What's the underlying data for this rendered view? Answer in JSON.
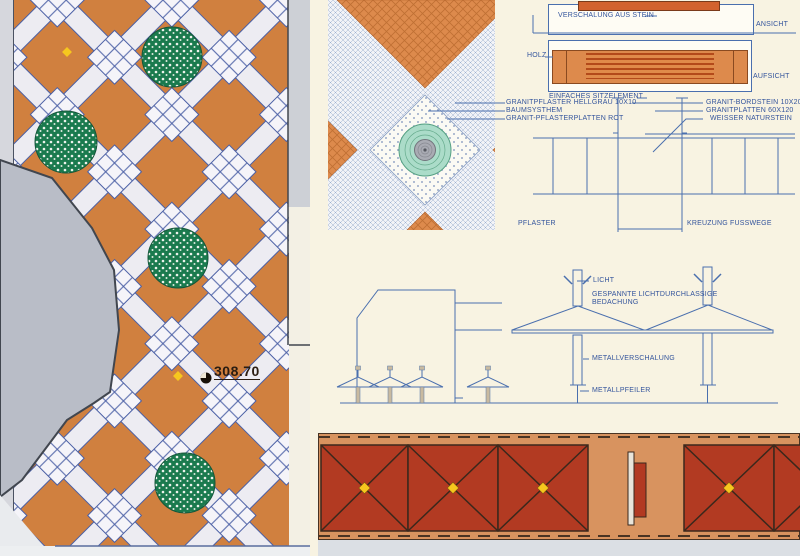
{
  "colors": {
    "paper": "#f8f3e2",
    "plan-orange": "#d0803f",
    "lattice-white": "#edecf2",
    "plaza-gray": "#b9bdc7",
    "walk-gray": "#cdd0d6",
    "tree-green": "#1a7a4e",
    "accent-yellow": "#f6c71e",
    "line-blue": "#4a6fae",
    "label-blue": "#33549c",
    "detail-orange": "#dd8a4c",
    "teal": "#abdcc9",
    "strip-orange": "#d8935f",
    "strip-red": "#b23a22",
    "bench-red": "#d2622e"
  },
  "plan": {
    "spot_elevation": "308.70"
  },
  "bench_detail": {
    "verschalung_label": "VERSCHALUNG AUS STEIN",
    "front_view_label": "ANSICHT",
    "material_label": "HOLZ",
    "top_view_label": "AUFSICHT",
    "caption": "EINFACHES SITZELEMENT"
  },
  "crossing_detail": {
    "material_labels_left": [
      "GRANITPFLASTER HELLGRAU 10X10",
      "BAUMSYSTHEM",
      "GRANIT-PFLASTERPLATTEN ROT"
    ],
    "material_labels_right": [
      "GRANIT-BORDSTEIN 10X20",
      "GRANITPLATTEN 60X120",
      "WEISSER NATURSTEIN"
    ],
    "pflaster_label": "PFLASTER",
    "caption": "KREUZUNG FUSSWEGE"
  },
  "canopy_detail": {
    "licht_label": "LICHT",
    "bedachung_label_line1": "GESPANNTE LICHTDURCHLASSIGE",
    "bedachung_label_line2": "BEDACHUNG",
    "metallverschalung_label": "METALLVERSCHALUNG",
    "metallpfeiler_label": "METALLPFEILER"
  }
}
